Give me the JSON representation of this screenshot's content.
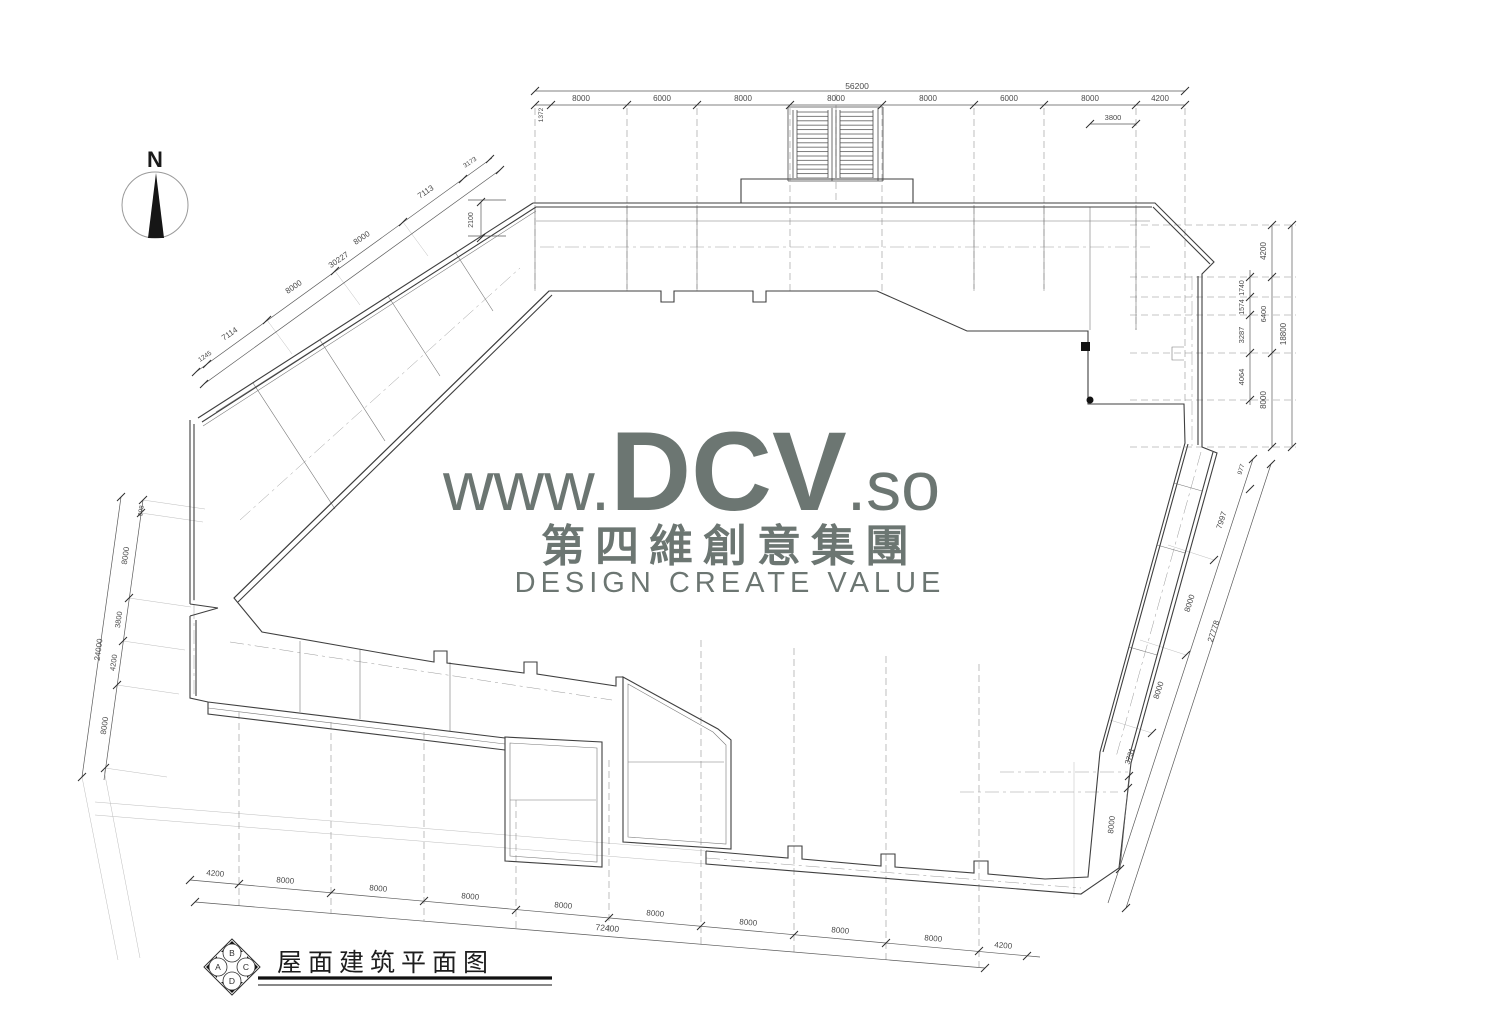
{
  "colors": {
    "watermark": "#6c7672",
    "ink": "#3f3f3f",
    "dim": "#4a4a4a"
  },
  "north": {
    "label": "N"
  },
  "watermark": {
    "url_prefix": "www.",
    "brand": "DCV",
    "url_suffix": ".so",
    "company_cjk": "第四維創意集團",
    "tagline": "DESIGN CREATE VALUE"
  },
  "title_block": {
    "title": "屋面建筑平面图",
    "grid_labels": [
      "A",
      "B",
      "C",
      "D"
    ]
  },
  "dimension_labels": [
    {
      "t": "56200",
      "x": 857,
      "y": 89,
      "r": 0,
      "s": 8.5
    },
    {
      "t": "8000",
      "x": 581,
      "y": 101,
      "r": 0,
      "s": 8
    },
    {
      "t": "6000",
      "x": 662,
      "y": 101,
      "r": 0,
      "s": 8
    },
    {
      "t": "8000",
      "x": 743,
      "y": 101,
      "r": 0,
      "s": 8
    },
    {
      "t": "8000",
      "x": 836,
      "y": 101,
      "r": 0,
      "s": 8
    },
    {
      "t": "8000",
      "x": 928,
      "y": 101,
      "r": 0,
      "s": 8
    },
    {
      "t": "6000",
      "x": 1009,
      "y": 101,
      "r": 0,
      "s": 8
    },
    {
      "t": "8000",
      "x": 1090,
      "y": 101,
      "r": 0,
      "s": 8
    },
    {
      "t": "4200",
      "x": 1160,
      "y": 101,
      "r": 0,
      "s": 8
    },
    {
      "t": "1372",
      "x": 543,
      "y": 115,
      "r": -90,
      "s": 6.5
    },
    {
      "t": "3800",
      "x": 1113,
      "y": 120,
      "r": 0,
      "s": 7.5
    },
    {
      "t": "2100",
      "x": 473,
      "y": 220,
      "r": -90,
      "s": 7
    },
    {
      "t": "3173",
      "x": 471,
      "y": 164,
      "r": -34,
      "s": 6.5
    },
    {
      "t": "7113",
      "x": 427,
      "y": 194,
      "r": -34,
      "s": 8
    },
    {
      "t": "8000",
      "x": 363,
      "y": 240,
      "r": -34,
      "s": 8
    },
    {
      "t": "30227",
      "x": 340,
      "y": 262,
      "r": -34,
      "s": 8
    },
    {
      "t": "8000",
      "x": 295,
      "y": 289,
      "r": -34,
      "s": 8
    },
    {
      "t": "7114",
      "x": 231,
      "y": 336,
      "r": -34,
      "s": 8
    },
    {
      "t": "1245",
      "x": 206,
      "y": 358,
      "r": -34,
      "s": 6.5
    },
    {
      "t": "4200",
      "x": 1266,
      "y": 251,
      "r": -90,
      "s": 8
    },
    {
      "t": "1740",
      "x": 1244,
      "y": 288,
      "r": -90,
      "s": 7
    },
    {
      "t": "1574",
      "x": 1244,
      "y": 307,
      "r": -90,
      "s": 7
    },
    {
      "t": "3287",
      "x": 1244,
      "y": 335,
      "r": -90,
      "s": 7.5
    },
    {
      "t": "6400",
      "x": 1266,
      "y": 314,
      "r": -90,
      "s": 7.5
    },
    {
      "t": "18800",
      "x": 1286,
      "y": 334,
      "r": -90,
      "s": 8
    },
    {
      "t": "4064",
      "x": 1244,
      "y": 377,
      "r": -90,
      "s": 7.5
    },
    {
      "t": "8000",
      "x": 1266,
      "y": 400,
      "r": -90,
      "s": 8
    },
    {
      "t": "977",
      "x": 1243,
      "y": 470,
      "r": -72,
      "s": 6.5
    },
    {
      "t": "7997",
      "x": 1224,
      "y": 521,
      "r": -72,
      "s": 8
    },
    {
      "t": "8000",
      "x": 1192,
      "y": 604,
      "r": -72,
      "s": 8
    },
    {
      "t": "27778",
      "x": 1216,
      "y": 632,
      "r": -72,
      "s": 8
    },
    {
      "t": "8000",
      "x": 1161,
      "y": 691,
      "r": -72,
      "s": 8
    },
    {
      "t": "3731",
      "x": 1132,
      "y": 757,
      "r": -72,
      "s": 7.5
    },
    {
      "t": "8000",
      "x": 1114,
      "y": 825,
      "r": -84,
      "s": 8
    },
    {
      "t": "998",
      "x": 143,
      "y": 511,
      "r": -82,
      "s": 6.5
    },
    {
      "t": "8000",
      "x": 128,
      "y": 556,
      "r": -82,
      "s": 8
    },
    {
      "t": "3800",
      "x": 121,
      "y": 620,
      "r": -82,
      "s": 7.5
    },
    {
      "t": "24000",
      "x": 101,
      "y": 650,
      "r": -82,
      "s": 8
    },
    {
      "t": "4200",
      "x": 116,
      "y": 663,
      "r": -82,
      "s": 7.5
    },
    {
      "t": "8000",
      "x": 107,
      "y": 726,
      "r": -82,
      "s": 8
    },
    {
      "t": "4200",
      "x": 215,
      "y": 876,
      "r": 5,
      "s": 8
    },
    {
      "t": "8000",
      "x": 285,
      "y": 883,
      "r": 5,
      "s": 8
    },
    {
      "t": "8000",
      "x": 378,
      "y": 891,
      "r": 5,
      "s": 8
    },
    {
      "t": "8000",
      "x": 470,
      "y": 899,
      "r": 5,
      "s": 8
    },
    {
      "t": "8000",
      "x": 563,
      "y": 908,
      "r": 5,
      "s": 8
    },
    {
      "t": "8000",
      "x": 655,
      "y": 916,
      "r": 5,
      "s": 8
    },
    {
      "t": "72400",
      "x": 607,
      "y": 931,
      "r": 5,
      "s": 8.5
    },
    {
      "t": "8000",
      "x": 748,
      "y": 925,
      "r": 5,
      "s": 8
    },
    {
      "t": "8000",
      "x": 840,
      "y": 933,
      "r": 5,
      "s": 8
    },
    {
      "t": "8000",
      "x": 933,
      "y": 941,
      "r": 5,
      "s": 8
    },
    {
      "t": "4200",
      "x": 1003,
      "y": 948,
      "r": 5,
      "s": 8
    }
  ]
}
